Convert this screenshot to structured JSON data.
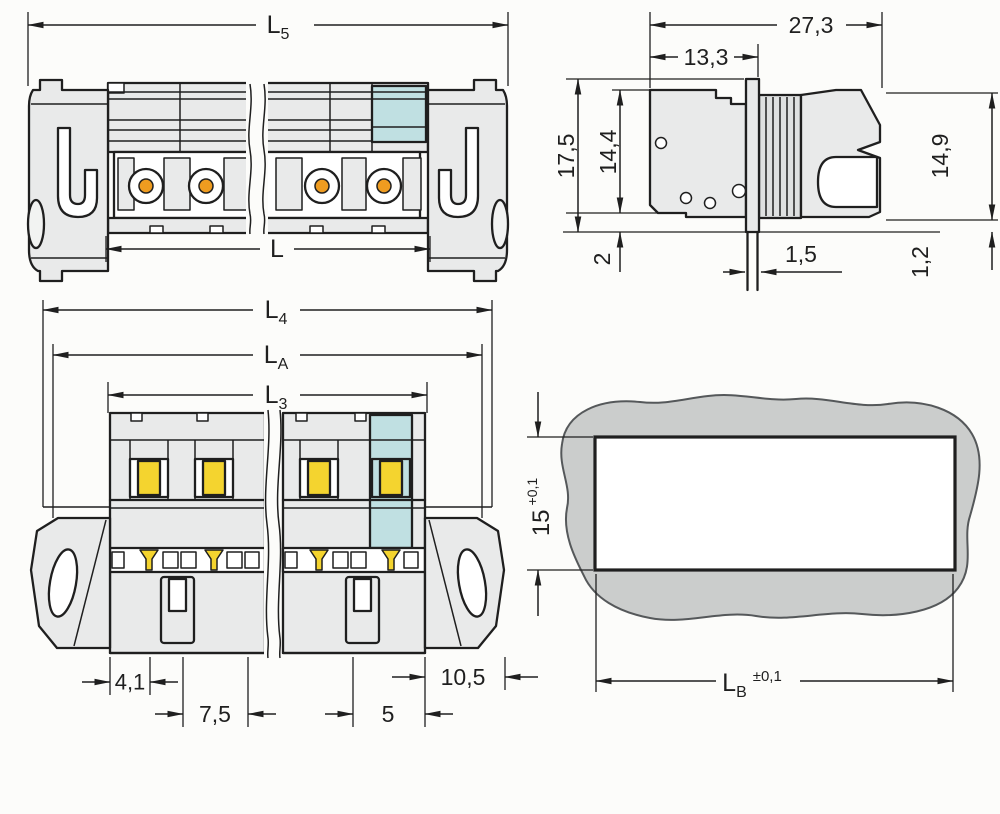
{
  "colors": {
    "line": "#1f1f1f",
    "body_gray": "#e9eaea",
    "body_gray_dark": "#dfe1e1",
    "button_gray": "#f2f3f2",
    "coding_teal": "#c0e0e2",
    "contact_orange": "#ef9c20",
    "contact_yellow": "#f4d42f",
    "panel_gray": "#cbcdcc",
    "background": "#fcfcfa"
  },
  "side_view": {
    "dim_total_length": {
      "main": "L",
      "sub": "5"
    },
    "dim_contact_length": {
      "main": "L",
      "sub": ""
    }
  },
  "end_view": {
    "dim_total_width": "27,3",
    "dim_front_width": "13,3",
    "dim_total_height": "17,5",
    "dim_body_height": "14,4",
    "dim_plug_height": "14,9",
    "dim_bottom_offset": "2",
    "dim_flange_thickness": "1,5",
    "dim_plug_gap": "1,2"
  },
  "top_view": {
    "dim_l4": {
      "main": "L",
      "sub": "4"
    },
    "dim_la": {
      "main": "L",
      "sub": "A"
    },
    "dim_l3": {
      "main": "L",
      "sub": "3"
    },
    "dim_edge_to_first_pole": "4,1",
    "dim_pitch_left": "7,5",
    "dim_pitch_right": "5",
    "dim_last_pole_to_edge": "10,5"
  },
  "panel_cutout_view": {
    "dim_cutout_height": {
      "value": "15",
      "tolerance": "+0,1"
    },
    "dim_cutout_width": {
      "main": "L",
      "sub": "B",
      "tolerance": "±0,1"
    }
  }
}
